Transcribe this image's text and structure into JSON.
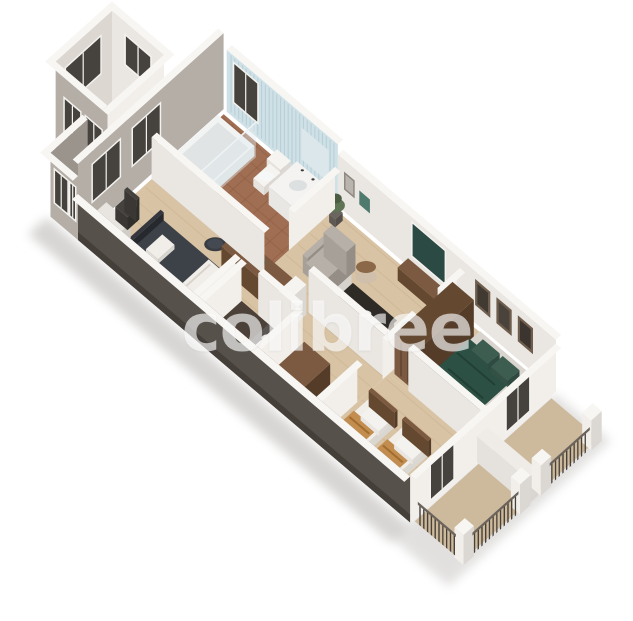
{
  "watermark": {
    "text": "colibree",
    "color": "rgba(255,255,255,0.63)"
  },
  "background": "#ffffff",
  "palette": {
    "shadow": "#7d7872",
    "wallTop": "#f8f6f3",
    "wallBright": "#f2efeb",
    "wallLight": "#eae6e1",
    "wallMid": "#dcd7d1",
    "wallShade": "#b4aea7",
    "wallDark": "#9a948d",
    "extDark": "#57514b",
    "extDark2": "#453f3a",
    "stairFloor": "#b5b1ac",
    "blueWall": "#cfe1e6",
    "blueStripe": "#b4ccd4",
    "glass": "#46423e",
    "glassFrame": "#f4f2ef",
    "floorWood": "#d8c3a4",
    "floorWoodLine": "#c2a987",
    "floorTerra": "#a06e52",
    "floorTerraLine": "#8a5a40",
    "floorTileDark": "#4c4138",
    "balconyFloor": "#cdb99b",
    "wood": "#7c5a41",
    "woodDark": "#644830",
    "woodSide": "#543c29",
    "woodLine": "#46311f",
    "counter": "#2e2a26",
    "bedDark": "#34373d",
    "bedDarkTop": "#3d4148",
    "bedDarkSide": "#2a2d32",
    "linen": "#f1eee9",
    "greenBed": "#2c5044",
    "greenBedDark": "#223f35",
    "greenPillow": "#3d5d51",
    "tan": "#c28d4e",
    "tanDark": "#a16d2f",
    "sofa": "#a7a099",
    "sofaTop": "#b7b0a8",
    "sofaSide": "#958e87",
    "rail": "#474139",
    "railTop": "#6b645c",
    "plant": "#5f7355",
    "plantDark": "#4a5c42",
    "white": "#f5f4f1",
    "whiteFace": "#e7e4df",
    "whiteSide": "#dbd8d3"
  }
}
